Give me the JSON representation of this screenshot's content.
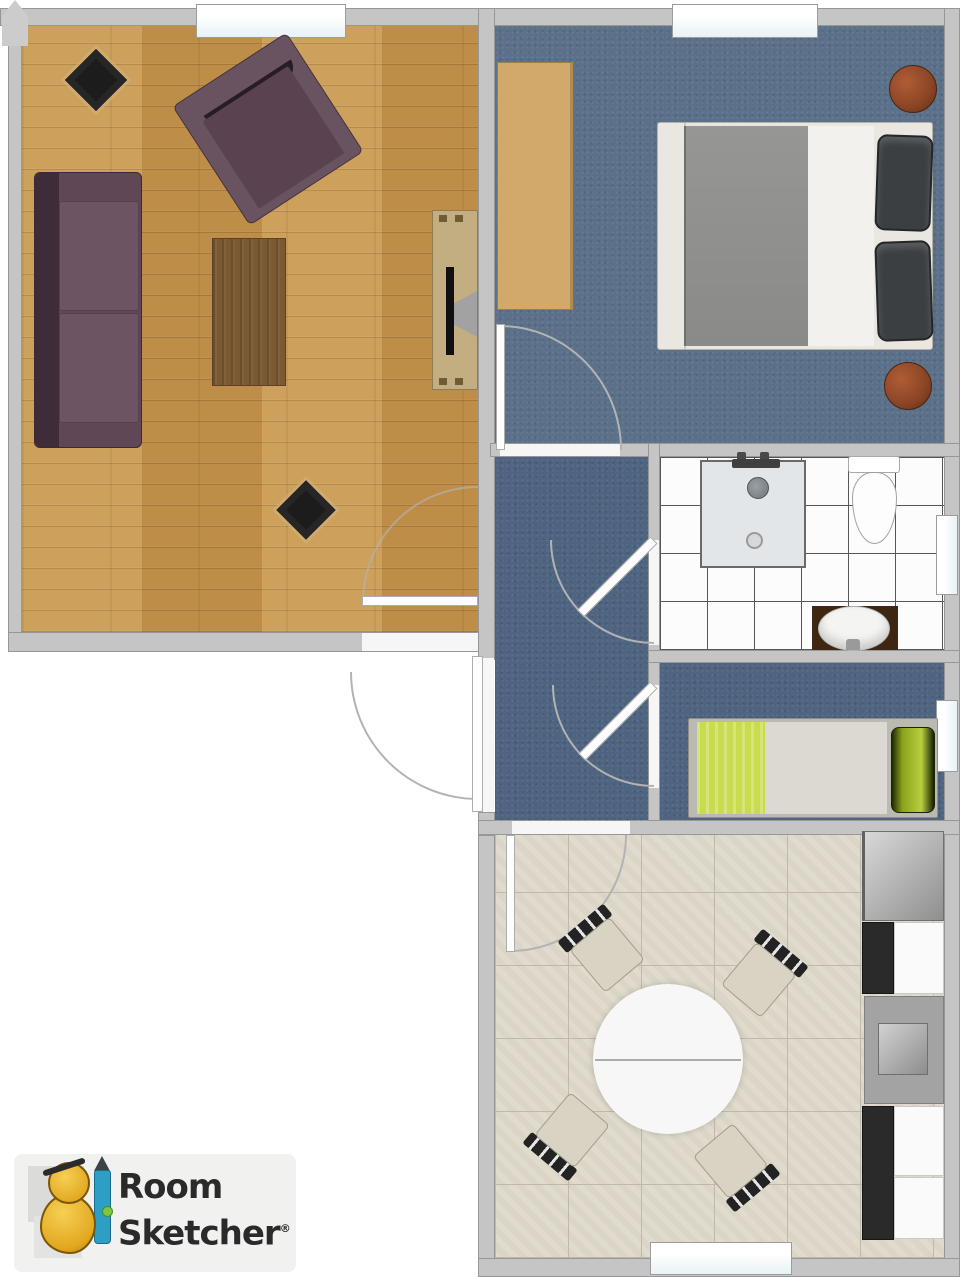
{
  "document": {
    "type": "2d-floor-plan",
    "brand": "RoomSketcher"
  },
  "logo": {
    "word1": "Room",
    "word2": "Sketcher",
    "registered_mark": "®"
  },
  "palette": {
    "wall": "#c5c5c5",
    "wall_edge": "#979797",
    "wood_floor": "#c6964f",
    "bedroom_carpet": "#5b7089",
    "hallway_carpet": "#4e6480",
    "small_bedroom_carpet": "#4e6480",
    "bathroom_tile": "#fcfcfc",
    "tile_grout": "#565656",
    "kitchen_floor": "#ded9ca",
    "kitchen_grout": "#bfb9a9",
    "sofa": "#6b5260",
    "armchair": "#6a5361",
    "area_rug": "#7a5a33",
    "tv_cabinet": "#c3ae81",
    "desk": "#d2a96b",
    "bed_blanket_grey": "#8f8f8d",
    "bed_pillows_dark": "#3b3f42",
    "pouf_brown": "#8a4526",
    "single_bed_blanket": "#c9db4e",
    "single_bed_pillow": "#9ab520",
    "counter_black": "#2a2a2a",
    "counter_white": "#fafafa",
    "appliance_grey": "#a3a3a3",
    "dining_table": "#f7f7f7",
    "chair_seat": "#d9d3c4",
    "door_arc": "#b3b3b3",
    "window_pane": "#e8f2f5",
    "logo_text": "#2a2a2a",
    "logo_mascot_yellow": "#e2a81f",
    "logo_pencil_teal": "#2e9fc4"
  },
  "rooms": [
    {
      "name": "living-room",
      "floor": "hardwood"
    },
    {
      "name": "bedroom",
      "floor": "blue-carpet"
    },
    {
      "name": "bathroom",
      "floor": "white-tile"
    },
    {
      "name": "small-bedroom",
      "floor": "blue-carpet"
    },
    {
      "name": "hallway",
      "floor": "blue-carpet"
    },
    {
      "name": "kitchen-dining",
      "floor": "beige-tile"
    }
  ],
  "furniture": {
    "living_room": [
      "sofa",
      "armchair",
      "area-rug",
      "tv-cabinet",
      "tv",
      "speaker",
      "speaker"
    ],
    "bedroom": [
      "double-bed",
      "desk",
      "pouf",
      "pouf"
    ],
    "bathroom": [
      "shower",
      "toilet",
      "sink-vanity"
    ],
    "small_bedroom": [
      "single-bed"
    ],
    "kitchen_dining": [
      "round-dining-table",
      "chair",
      "chair",
      "chair",
      "chair",
      "fridge",
      "kitchen-sink",
      "counter-black",
      "counter-white"
    ]
  },
  "openings": {
    "window_count": 5,
    "door_count": 6
  }
}
